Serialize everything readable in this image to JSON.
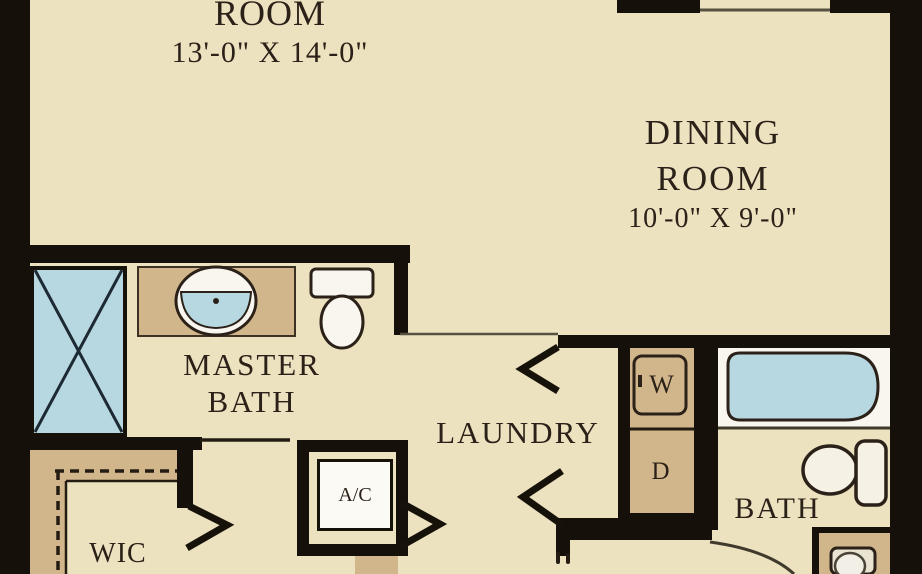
{
  "plan_title": "apartment floor plan (cropped)",
  "colors": {
    "floor_beige": "#ece2c0",
    "wall_black": "#15100a",
    "fixture_tan": "#d2b68b",
    "water_blue": "#b7d8e1",
    "text_brown": "#2b2118",
    "fixture_white": "#f8f6ef"
  },
  "rooms": {
    "room": {
      "label": "ROOM",
      "dimensions": "13'-0\" X 14'-0\""
    },
    "dining": {
      "label_line1": "DINING",
      "label_line2": "ROOM",
      "dimensions": "10'-0\" X 9'-0\""
    },
    "master_bath": {
      "label_line1": "MASTER",
      "label_line2": "BATH"
    },
    "laundry": {
      "label": "LAUNDRY"
    },
    "wic": {
      "label": "WIC"
    },
    "bath": {
      "label": "BATH"
    },
    "ac_closet": {
      "label": "A/C"
    }
  },
  "appliances": {
    "washer": "W",
    "dryer": "D"
  }
}
